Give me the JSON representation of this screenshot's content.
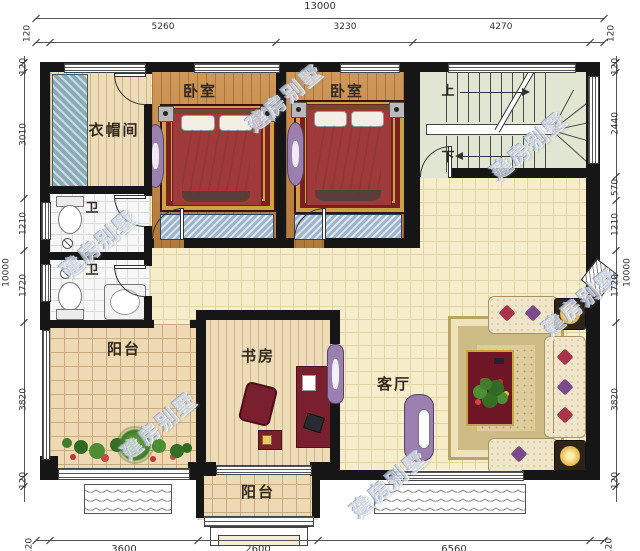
{
  "watermark": "建房别墅",
  "rooms": {
    "cloakroom": "衣帽间",
    "bedroom_left": "卧室",
    "bedroom_middle": "卧室",
    "bath_upper": "卫",
    "bath_lower": "卫",
    "balcony_left": "阳台",
    "balcony_bottom": "阳台",
    "study": "书房",
    "living_room": "客厅",
    "stairs_up": "上",
    "stairs_down": "下"
  },
  "dims": {
    "top": {
      "total": "13000",
      "segments": [
        "120",
        "5260",
        "3230",
        "4270",
        "120"
      ]
    },
    "left": {
      "total": "10000",
      "segments": [
        "120",
        "3010",
        "1210",
        "1720",
        "3820",
        "120"
      ]
    },
    "right": {
      "total": "10000",
      "segments": [
        "120",
        "2440",
        "570",
        "1210",
        "1720",
        "3820",
        "120"
      ]
    },
    "bottom": {
      "segments": [
        "120",
        "3600",
        "2600",
        "6560",
        "120"
      ]
    }
  },
  "colors": {
    "wall": "#161616",
    "bedroom_floor": "#c98a42",
    "living_floor": "#f6eecb",
    "stair_floor": "#e0e6d2",
    "rug": "#7c1f1f",
    "accent_gold": "#caa24a",
    "wardrobe": "#88aab6",
    "watermark": "#ccd5e4"
  }
}
